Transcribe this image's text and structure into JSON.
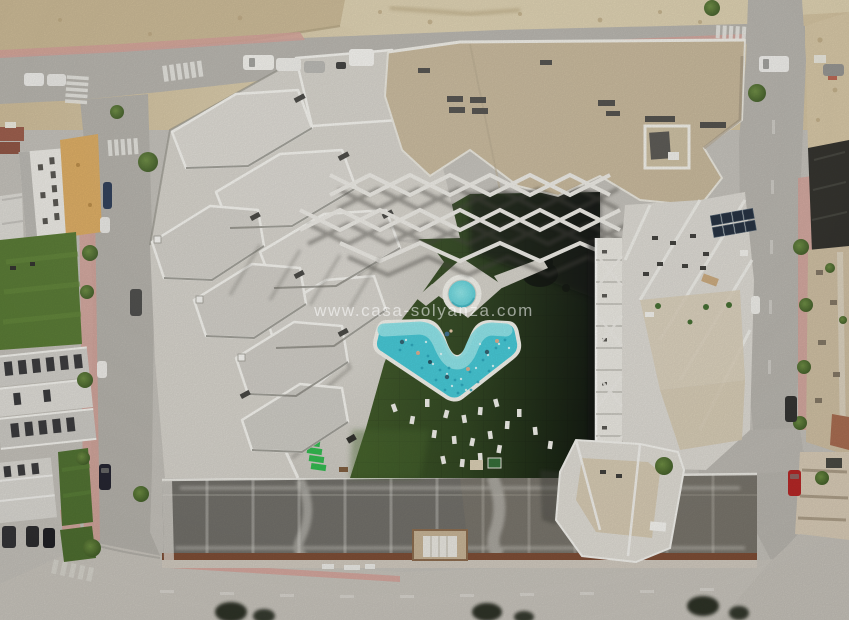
{
  "meta": {
    "kind": "aerial-photograph",
    "view": "top-down drone view",
    "subject": "residential apartment complex with communal pool, lawn courtyard, streets and vacant dirt lot"
  },
  "watermark": {
    "text": "www.casa-solyanza.com",
    "color": "#ffffff",
    "opacity": 0.55
  },
  "palette": {
    "dirt": "#d2c19e",
    "road": "#b5b2ab",
    "road_light": "#c6c2ba",
    "sidewalk_pink": "#d3a096",
    "roof_white": "#d8d5ce",
    "parapet_white": "#f0efe9",
    "roof_beige": "#c6b698",
    "turf_green": "#3c5723",
    "turf_shadow": "#121a0c",
    "pool_deep": "#3fc6d4",
    "pool_shallow": "#8de4e8",
    "pool_rim": "#f2f1ea",
    "parking_slab": "#74726c",
    "parapet_brown": "#7c4b33",
    "lawn": "#55752f",
    "tree": "#45632c",
    "solar_panel": "#1e2a3a",
    "lounger_green": "#2eb84c",
    "car_red": "#b32423"
  },
  "scene": {
    "main_pool": {
      "shape": "chevron",
      "people_in_water": 7
    },
    "kids_pool": {
      "shape": "round"
    },
    "sun_loungers_on_lawn": 19,
    "stacked_green_loungers": 5,
    "parked_cars_visible": 20
  }
}
